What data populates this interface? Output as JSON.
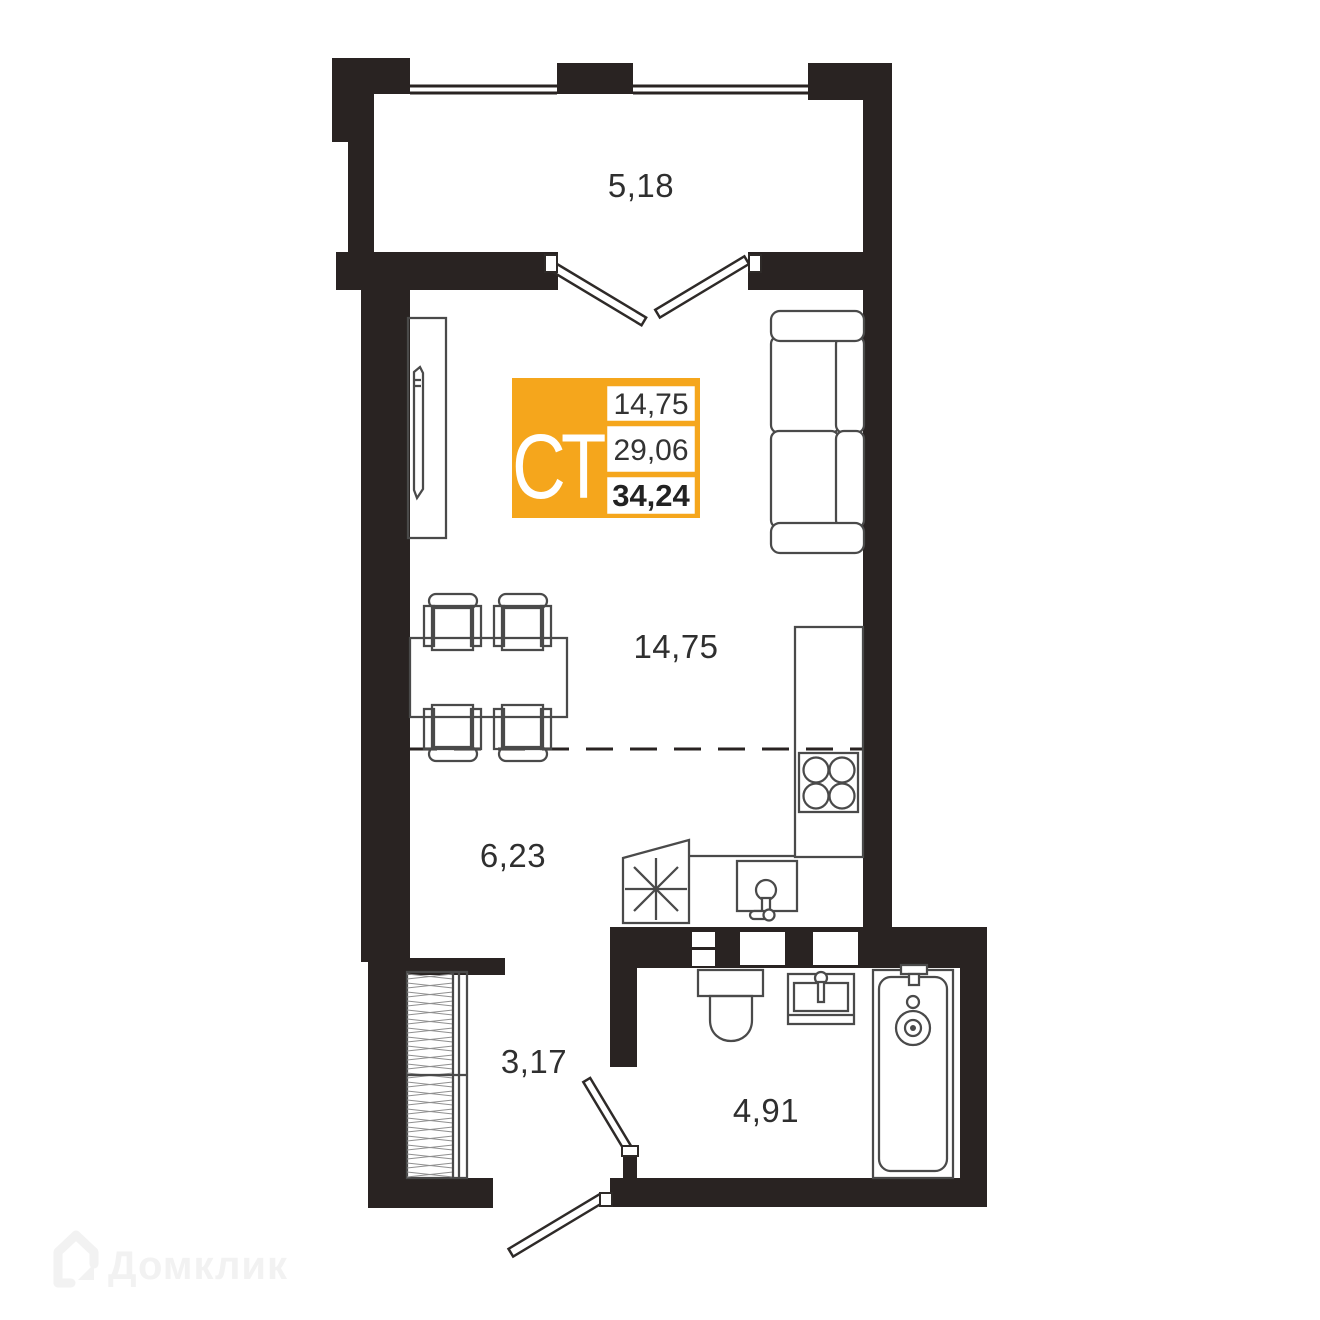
{
  "colors": {
    "wall": "#292322",
    "furniture": "#4a4a4a",
    "label": "#2f2f2f",
    "badge_orange": "#F5A61C",
    "badge_text": "#333333",
    "watermark": "#f2f2f2",
    "background": "#ffffff"
  },
  "plan": {
    "watermark": {
      "text": "Домклик"
    },
    "badge": {
      "type": "СТ",
      "values": [
        "14,75",
        "29,06",
        "34,24"
      ]
    },
    "areas": {
      "balcony": "5,18",
      "main_room": "14,75",
      "living_zone": "6,23",
      "hallway": "3,17",
      "bathroom": "4,91"
    }
  }
}
